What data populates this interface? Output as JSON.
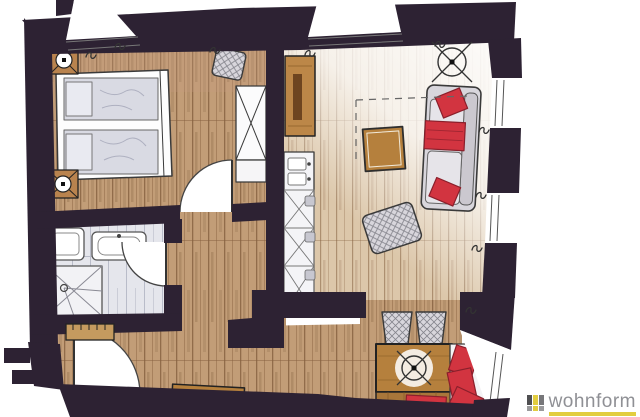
{
  "brand": {
    "name": "wohnform"
  },
  "colors": {
    "background": "#ffffff",
    "wall": "#2d2233",
    "outline": "#3a3a3a",
    "wood_base": "#c29d77",
    "wood_grain": "#85603f",
    "wood_light": "#dcc7aa",
    "tile": "#e5e6ec",
    "tile_grain": "#b9bcc9",
    "furniture_gray": "#d8d6dc",
    "mattress": "#d9dae3",
    "accent_red": "#d23440",
    "red_dark": "#8a1f2b",
    "table_wood": "#b5803d",
    "sideboard_wood": "#bc8748",
    "radiator_wood": "#c49a5f",
    "logo_text": "#8f9095",
    "logo_yellow": "#e2cd3f",
    "logo_dark": "#4f4f51",
    "logo_mid": "#77777a",
    "logo_light": "#9a9a9c"
  },
  "rooms": [
    {
      "name": "bedroom"
    },
    {
      "name": "bathroom"
    },
    {
      "name": "hallway"
    },
    {
      "name": "corridor"
    },
    {
      "name": "kitchen"
    },
    {
      "name": "living-room"
    },
    {
      "name": "dining-nook"
    }
  ],
  "furniture": [
    "double-bed",
    "bedside-spotlights",
    "wardrobe",
    "dressing-stool",
    "bathroom-sink",
    "toilet",
    "shower",
    "kitchen-counter-with-sink",
    "sideboard",
    "coffee-table",
    "sofa-with-red-cushions",
    "ottoman",
    "dining-table",
    "wicker-chairs",
    "corner-bench-with-red-cushions",
    "doormat",
    "radiator",
    "entrance-door"
  ],
  "symbols": {
    "ceiling_lamp": "circle-with-x-icon",
    "spotlight": "square-circle-x-icon",
    "curtain": "s-squiggle-icon",
    "shower_drain": "circle-dot-icon",
    "window": "double-line-opening"
  }
}
